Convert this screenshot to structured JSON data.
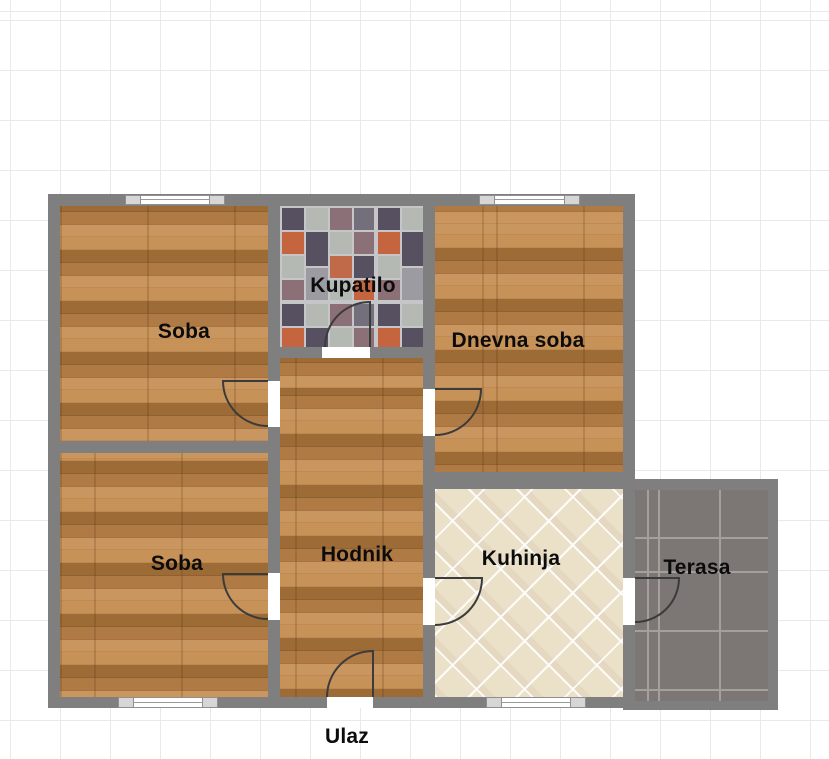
{
  "floorplan": {
    "title": "Apartment floor plan",
    "entrance_label": "Ulaz",
    "rooms": [
      {
        "id": "soba-top",
        "label": "Soba",
        "floor": "wood"
      },
      {
        "id": "kupatilo",
        "label": "Kupatilo",
        "floor": "mosaic-tile"
      },
      {
        "id": "dnevna-soba",
        "label": "Dnevna soba",
        "floor": "wood"
      },
      {
        "id": "soba-bottom",
        "label": "Soba",
        "floor": "wood"
      },
      {
        "id": "hodnik",
        "label": "Hodnik",
        "floor": "wood"
      },
      {
        "id": "kuhinja",
        "label": "Kuhinja",
        "floor": "diamond-tile"
      },
      {
        "id": "terasa",
        "label": "Terasa",
        "floor": "stone-tile"
      }
    ],
    "counts": {
      "windows": 4,
      "doors": 7
    },
    "colors": {
      "wall": "#7f7f7f",
      "grid_line": "#e9e9ea",
      "label_text": "#0c0c0c",
      "wood_base": "#b5803f",
      "kitchen_tile": "#ebe1c9",
      "terrace_tile": "#7c7774",
      "door_stroke": "#3b3b3b",
      "mosaic_dark": "#565061",
      "mosaic_light": "#b4b9b3",
      "mosaic_terracotta": "#c4653f",
      "mosaic_mauve": "#8b7077"
    }
  }
}
